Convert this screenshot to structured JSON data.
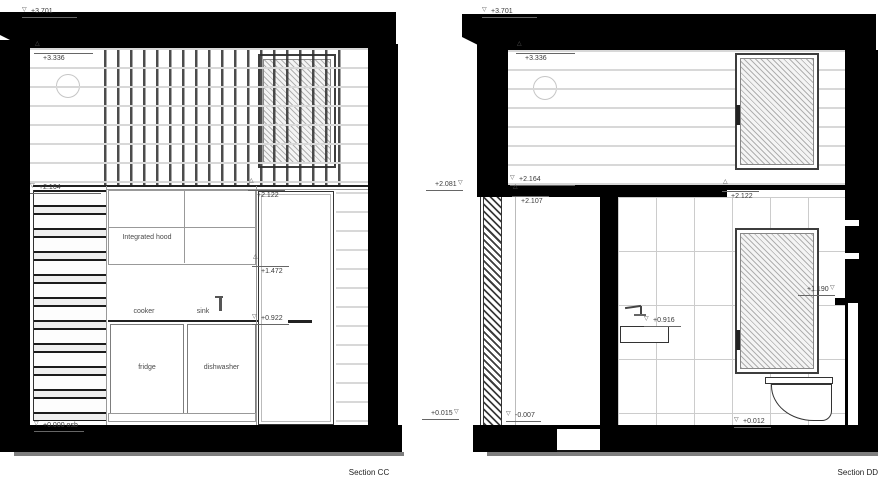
{
  "icons": {
    "triangle_down": "▽",
    "triangle_up": "△"
  },
  "colors": {
    "wall": "#000000",
    "outline": "#888888",
    "tile_grid": "#cccccc",
    "siding": "#d8d8d8",
    "text": "#3a3a3a"
  },
  "section_cc": {
    "caption": "Section CC",
    "levels": {
      "roof": "+3.701",
      "ceiling": "+3.336",
      "loft_floor": "+2.164",
      "door_head": "+2.122",
      "door_mid": "+1.472",
      "worktop": "+0.922",
      "floor": "+0.000 osb"
    },
    "labels": {
      "integrated_hood": "Integrated hood",
      "cooker": "cooker",
      "sink": "sink",
      "fridge": "fridge",
      "dishwasher": "dishwasher"
    }
  },
  "section_dd": {
    "caption": "Section DD",
    "levels": {
      "roof": "+3.701",
      "ceiling": "+3.336",
      "loft_exterior": "+2.081",
      "loft_floor": "+2.164",
      "loft_underside": "+2.107",
      "bath_ceiling": "+2.122",
      "window_sill": "+1.190",
      "basin": "+0.916",
      "exterior_floor": "+0.015",
      "floor": "-0.007",
      "toilet": "+0.012"
    }
  }
}
